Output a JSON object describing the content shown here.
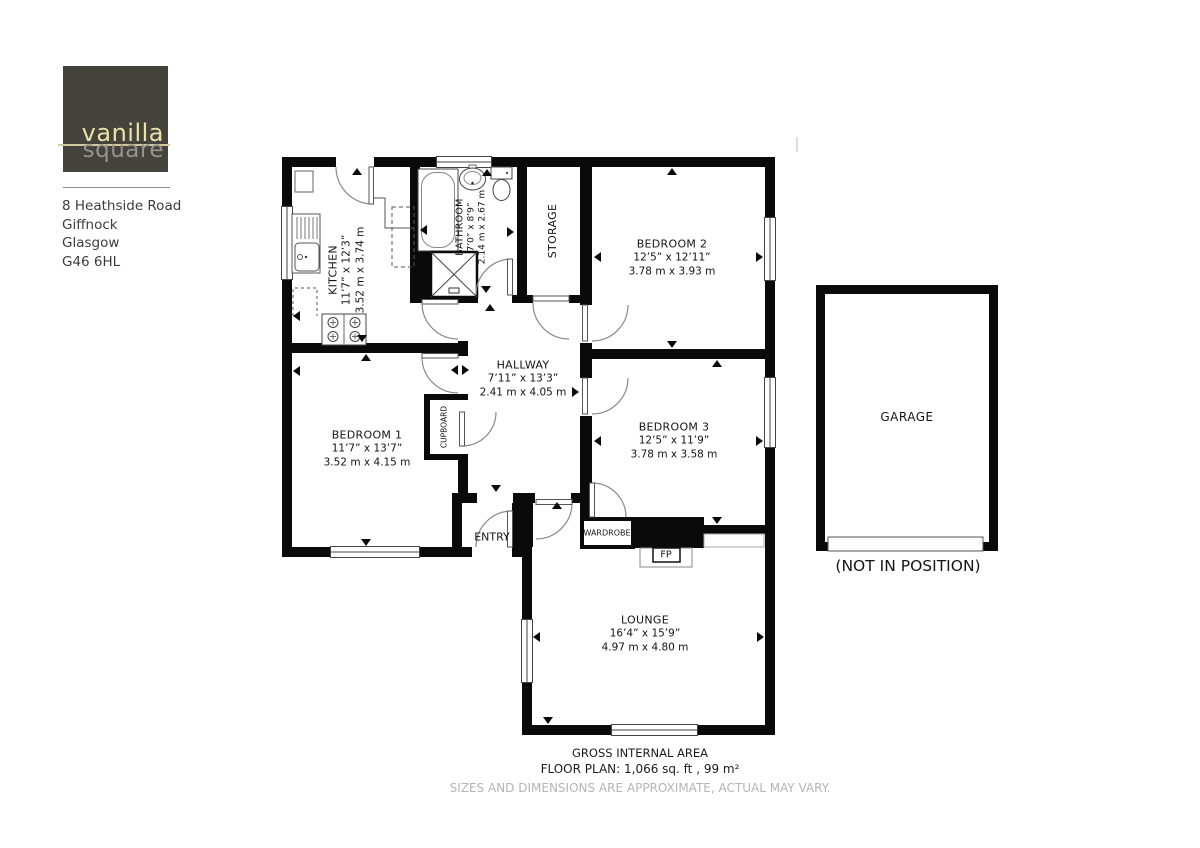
{
  "brand": {
    "logo_primary": "vanilla",
    "logo_secondary": "square",
    "address_lines": [
      "8 Heathside Road",
      "Giffnock",
      "Glasgow",
      "G46 6HL"
    ]
  },
  "rooms": [
    {
      "name": "KITCHEN",
      "imperial": "11’7” x 12’3”",
      "metric": "3.52 m x 3.74 m"
    },
    {
      "name": "BATHROOM",
      "imperial": "7’0” x 8’9”",
      "metric": "2.14 m x 2.67 m"
    },
    {
      "name": "STORAGE"
    },
    {
      "name": "BEDROOM 2",
      "imperial": "12’5” x 12’11”",
      "metric": "3.78 m x 3.93 m"
    },
    {
      "name": "HALLWAY",
      "imperial": "7’11” x 13’3”",
      "metric": "2.41 m x 4.05 m"
    },
    {
      "name": "BEDROOM 1",
      "imperial": "11’7” x 13’7”",
      "metric": "3.52 m x 4.15 m"
    },
    {
      "name": "BEDROOM 3",
      "imperial": "12’5” x 11’9”",
      "metric": "3.78 m x 3.58 m"
    },
    {
      "name": "LOUNGE",
      "imperial": "16’4” x 15’9”",
      "metric": "4.97 m x 4.80 m"
    }
  ],
  "features": {
    "cupboard": "CUPBOARD",
    "entry": "ENTRY",
    "wardrobe": "WARDROBE",
    "fireplace": "FP",
    "garage": "GARAGE",
    "garage_note": "(NOT IN POSITION)"
  },
  "footer": {
    "line1": "GROSS INTERNAL AREA",
    "line2": "FLOOR PLAN: 1,066 sq. ft , 99 m²",
    "line3": "SIZES AND DIMENSIONS ARE APPROXIMATE, ACTUAL MAY VARY."
  },
  "colors": {
    "wall": "#0a0a0a",
    "logo_bg": "#45443c",
    "logo_primary_text": "#ece0a9",
    "logo_secondary_text": "#96948c",
    "disclaimer_text": "#b5b5b5",
    "label_text": "#141414"
  }
}
